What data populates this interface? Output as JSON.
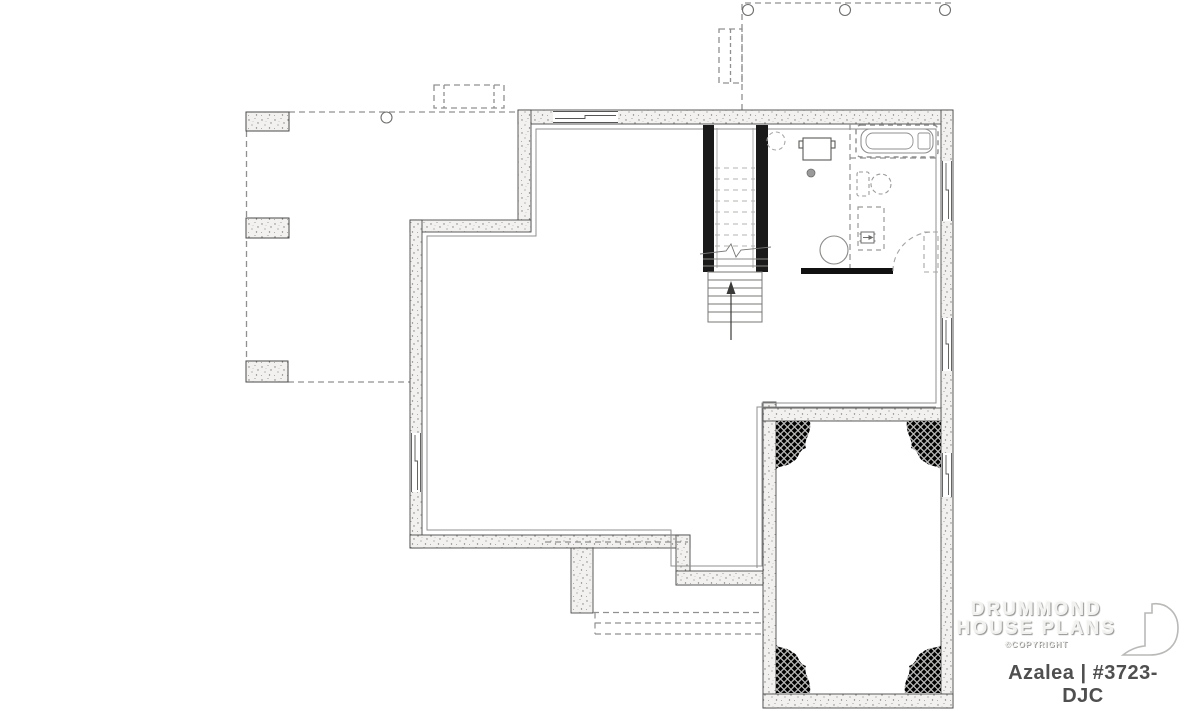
{
  "plan": {
    "label": "Azalea | #3723-DJC",
    "drawing_type": "basement floor plan"
  },
  "brand": {
    "name_line1": "DRUMMOND",
    "name_line2": "HOUSE PLANS",
    "copyright": "©COPYRIGHT"
  },
  "colors": {
    "background": "#ffffff",
    "wall_fill": "#f2f1ef",
    "wall_stroke": "#4a4a4a",
    "stair_wall": "#1a1a1a",
    "framed_wall": "#111111",
    "thin_line": "#8f8f8f",
    "dashed_line": "#909090",
    "fixture_line": "#8f8f8f",
    "hatch": "#b3b3b1",
    "drain_fill": "#9a9a9a",
    "watermark": "#b9b9b7"
  },
  "features": {
    "icons": [
      "staircase-up-arrow",
      "bathtub",
      "toilet",
      "water-heater",
      "pressure-tank",
      "floor-drain",
      "laundry-sink",
      "door-swing",
      "garage-corner-hatch",
      "deck-pier",
      "deck-post",
      "window",
      "drummond-logo"
    ]
  }
}
